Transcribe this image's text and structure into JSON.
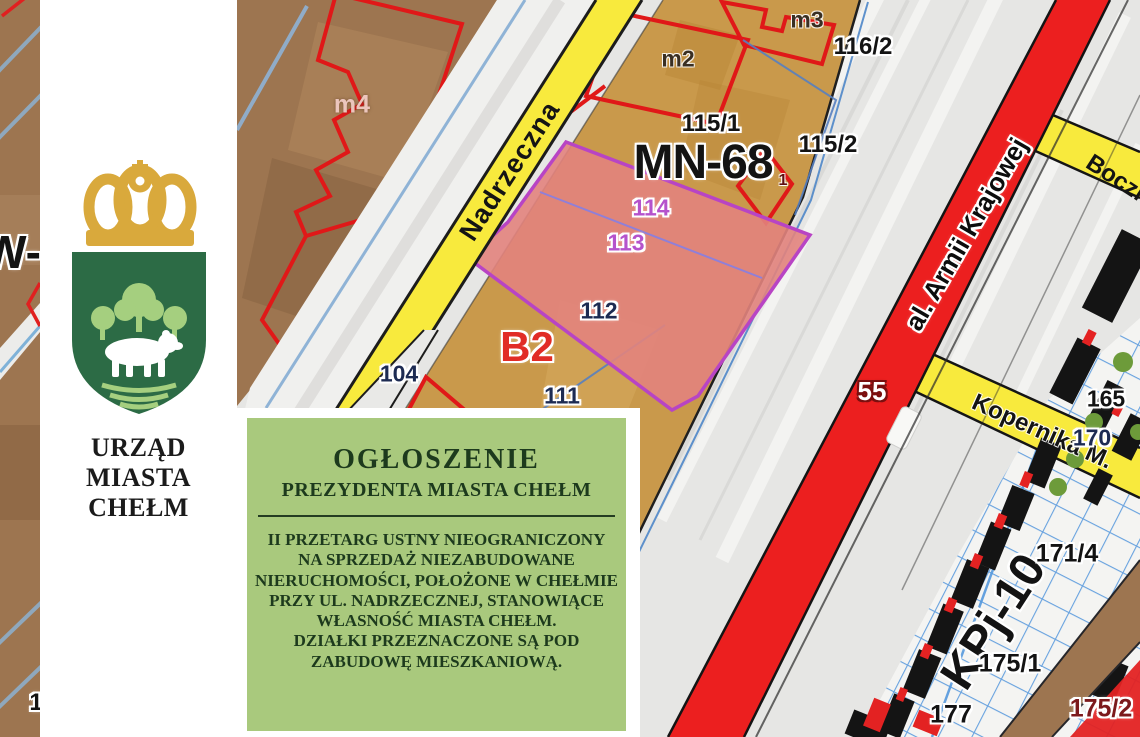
{
  "flyer": {
    "organization": {
      "line1": "URZĄD MIASTA",
      "line2": "CHEŁM"
    },
    "announcement": {
      "title": "OGŁOSZENIE",
      "subtitle": "PREZYDENTA MIASTA CHEŁM",
      "body": [
        "II PRZETARG USTNY NIEOGRANICZONY",
        "NA SPRZEDAŻ NIEZABUDOWANE",
        "NIERUCHOMOŚCI, POŁOŻONE W CHEŁMIE",
        "PRZY UL. NADRZECZNEJ, STANOWIĄCE",
        "WŁASNOŚĆ MIASTA CHEŁM.",
        "DZIAŁKI PRZEZNACZONE SĄ POD",
        "ZABUDOWĘ MIESZKANIOWĄ."
      ]
    },
    "colors": {
      "announcement_bg": "#a9c97d",
      "announcement_text": "#1d3a1d",
      "crown_gold": "#d9a93c",
      "shield_green": "#2c6b45",
      "tree_green": "#a5cf7f"
    }
  },
  "map": {
    "streets": {
      "nadrzeczna": "Nadrzeczna",
      "armii_krajowej": "al. Armii Krajowej",
      "boczna": "Boczna",
      "kopernika": "Kopernika M."
    },
    "zones": {
      "mn68": "MN-68",
      "b2": "B2",
      "kpj10": "KPj-10",
      "w": "W-"
    },
    "parcels": {
      "p104": "104",
      "p111": "111",
      "p112": "112",
      "p113": "113",
      "p114": "114",
      "p115_1": "115/1",
      "p115_2": "115/2",
      "p116_2": "116/2",
      "p165": "165",
      "p170": "170",
      "p171_4": "171/4",
      "p175_1": "175/1",
      "p175_2": "175/2",
      "p177": "177",
      "p55": "55",
      "p1": "1",
      "edge_partial": "1"
    },
    "buildings": {
      "m2": "m2",
      "m3": "m3",
      "m4": "m4"
    },
    "colors": {
      "primary_road": "#ec1f1f",
      "secondary_road": "#f8ea3d",
      "parcel_highlight": "#e2837d",
      "highlight_border": "#b844c4",
      "zone_tan": "#c9994b",
      "zone_brown": "#9d7550"
    }
  }
}
